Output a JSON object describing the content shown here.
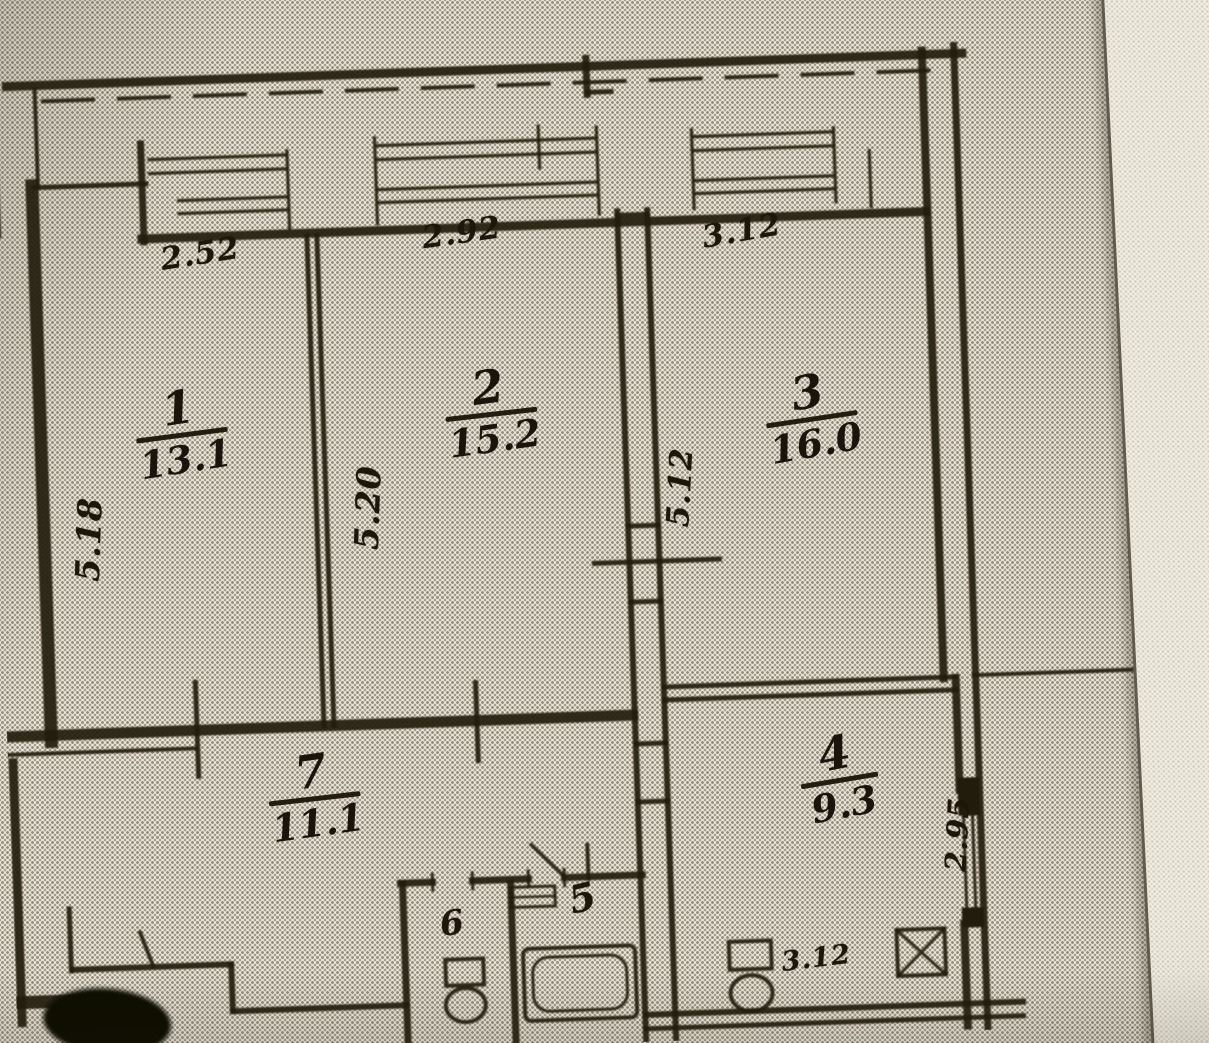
{
  "plan": {
    "rooms": [
      {
        "number": "1",
        "area": "13.1"
      },
      {
        "number": "2",
        "area": "15.2"
      },
      {
        "number": "3",
        "area": "16.0"
      },
      {
        "number": "4",
        "area": "9.3"
      },
      {
        "number": "5"
      },
      {
        "number": "6"
      },
      {
        "number": "7",
        "area": "11.1"
      }
    ],
    "dimensions": {
      "room1_width": "2.52",
      "room2_width": "2.92",
      "room3_width": "3.12",
      "room1_depth": "5.18",
      "room2_depth": "5.20",
      "room3_depth": "5.12",
      "kitchen_depth": "2.95",
      "kitchen_width": "3.12"
    },
    "colors": {
      "paper": "#ebe6d7",
      "ink": "#241c10",
      "marker": "#0b0906"
    }
  }
}
